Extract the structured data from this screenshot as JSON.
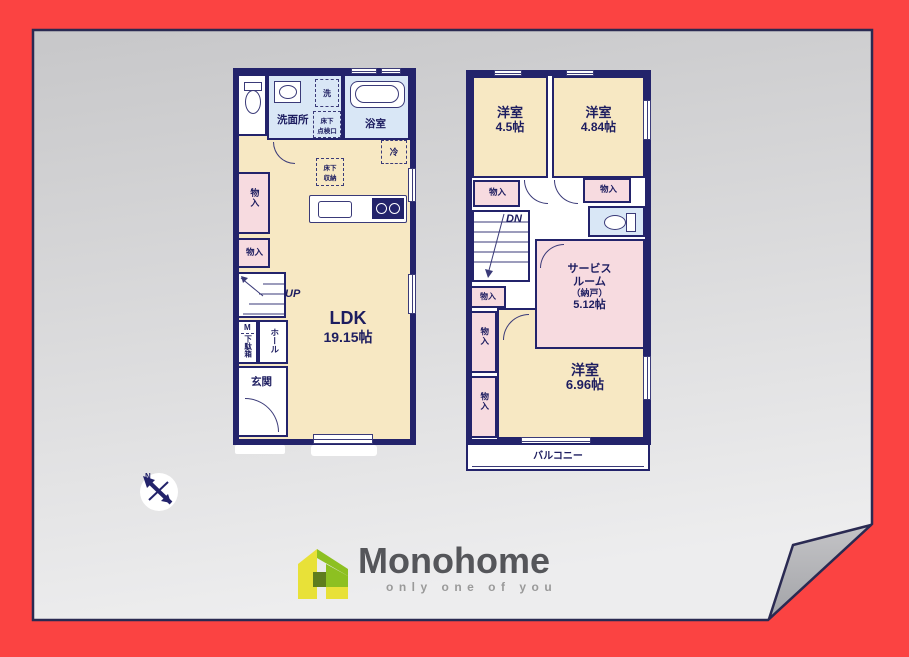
{
  "canvas": {
    "background_color": "#fb4342",
    "paper_top_color": "#c7c7c9",
    "paper_bottom_color": "#ededee",
    "wall_color": "#23236b"
  },
  "compass": {
    "label": "N"
  },
  "logo": {
    "brand": "Monohome",
    "tagline": "only one of you",
    "green": "#8dc021",
    "yellow": "#e8e138",
    "dark_green": "#5f7d1e",
    "brand_color": "#55565a",
    "tagline_color": "#9a9a9a"
  },
  "first_floor": {
    "ldk": {
      "name": "LDK",
      "size": "19.15帖"
    },
    "washroom": "洗面所",
    "bathroom": "浴室",
    "laundry": "洗",
    "floor_hatch": [
      "床下",
      "点検口"
    ],
    "floor_storage": [
      "床下",
      "収納"
    ],
    "fridge": "冷",
    "closet_tall": "物入",
    "closet_small": "物入",
    "stairs": "UP",
    "meter": "M",
    "shoe_box": "下駄箱",
    "hall": "ホール",
    "entrance": "玄関"
  },
  "second_floor": {
    "bedroom_a": {
      "name": "洋室",
      "size": "4.5帖"
    },
    "bedroom_b": {
      "name": "洋室",
      "size": "4.84帖"
    },
    "bedroom_c": {
      "name": "洋室",
      "size": "6.96帖"
    },
    "service_room": {
      "line1": "サービス",
      "line2": "ルーム",
      "line3": "（納戸）",
      "line4": "5.12帖"
    },
    "closet_a": "物入",
    "closet_b": "物入",
    "closet_c": "物入",
    "closet_d": "物入",
    "closet_e": "物入",
    "closet_f": "物入",
    "stairs": "DN",
    "balcony": "バルコニー"
  }
}
